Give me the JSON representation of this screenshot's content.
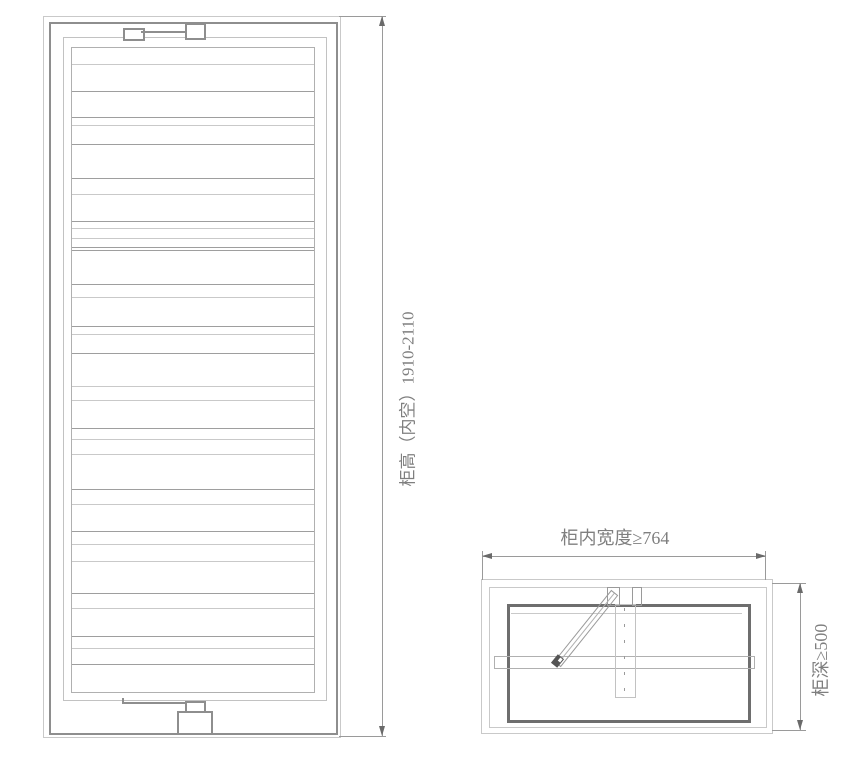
{
  "title": "cabinet-lift-rack-installation-diagram",
  "labels": {
    "cabinet_height": "柜高（内空）1910-2110",
    "cabinet_inner_width": "柜内宽度≥764",
    "cabinet_depth": "柜深≥500"
  },
  "dimensions": {
    "height_range_mm": "1910-2110",
    "min_inner_width_mm": 764,
    "min_depth_mm": 500
  },
  "colors": {
    "line-light": "#c9c9c9",
    "line-frame": "#c2c2c2",
    "line-med": "#b0b0b0",
    "line-strong": "#9e9e9e",
    "line-dark": "#8e8e8e",
    "plan-dark": "#6e6e6e",
    "dim": "#9a9a9a",
    "arrow": "#6a6a6a",
    "pivot": "#545454",
    "text": "#7f7f7f"
  },
  "front_view": {
    "slats": [
      {
        "y": 16,
        "s": 0
      },
      {
        "y": 43,
        "s": 1
      },
      {
        "y": 69,
        "s": 1
      },
      {
        "y": 77,
        "s": 0
      },
      {
        "y": 96,
        "s": 1
      },
      {
        "y": 130,
        "s": 1
      },
      {
        "y": 146,
        "s": 0
      },
      {
        "y": 173,
        "s": 1
      },
      {
        "y": 180,
        "s": 0
      },
      {
        "y": 190,
        "s": 0
      },
      {
        "y": 199,
        "s": 1
      },
      {
        "y": 202,
        "s": 1
      },
      {
        "y": 236,
        "s": 1
      },
      {
        "y": 249,
        "s": 0
      },
      {
        "y": 278,
        "s": 1
      },
      {
        "y": 286,
        "s": 0
      },
      {
        "y": 305,
        "s": 1
      },
      {
        "y": 338,
        "s": 0
      },
      {
        "y": 352,
        "s": 0
      },
      {
        "y": 380,
        "s": 1
      },
      {
        "y": 391,
        "s": 0
      },
      {
        "y": 406,
        "s": 0
      },
      {
        "y": 441,
        "s": 1
      },
      {
        "y": 456,
        "s": 0
      },
      {
        "y": 483,
        "s": 1
      },
      {
        "y": 496,
        "s": 0
      },
      {
        "y": 513,
        "s": 0
      },
      {
        "y": 545,
        "s": 1
      },
      {
        "y": 560,
        "s": 0
      },
      {
        "y": 588,
        "s": 1
      },
      {
        "y": 600,
        "s": 0
      },
      {
        "y": 616,
        "s": 1
      }
    ]
  }
}
